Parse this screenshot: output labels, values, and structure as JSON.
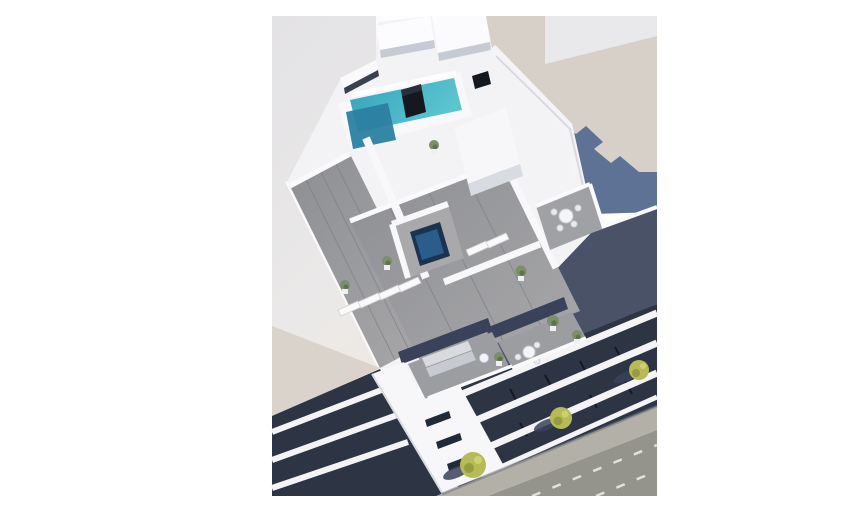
{
  "image": {
    "alt_text": "Aerial 3D architectural rendering of a modern white apartment building with a rooftop swimming pool, jacuzzi and sun-deck terraces, glass penthouse level, white balcony slabs over dark recessed floors, and a tree-lined street with dashed lane markings; portrait render centered on a white background"
  },
  "colors": {
    "page_white": "#ffffff",
    "sky_gray": "#e9e9eb",
    "ground_beige": "#d7d0c8",
    "shadow_blue": "#5e7296",
    "wall_gray": "#e6e5e8",
    "building_white": "#f3f3f5",
    "deck_gray": "#97989b",
    "pool_turquoise": "#41b6c8",
    "pool_deep": "#2b7fa0",
    "jacuzzi_navy": "#1c3350",
    "glass_blue": "#4a5268",
    "facade_dark": "#2d3545",
    "street_gray": "#94938c",
    "sidewalk_gray": "#b3b0a8",
    "lane_white": "#eceae2",
    "tree_green": "#b6bb58",
    "plant_green": "#7d8f6a"
  },
  "scene": {
    "elements": [
      "white background margins",
      "neighboring building wall (left)",
      "sunlit beige ground with stepped blue building shadow (top right)",
      "rooftop swimming pool with dark deep end",
      "black rooftop skylight boxes",
      "square navy jacuzzi on timber deck",
      "gray timber sun decks with white sun loungers",
      "potted green plants",
      "round white terrace dining tables with chairs",
      "penthouse terrace with corner sofa and coffee table",
      "dark glass penthouse walls",
      "white diagonal balcony slabs over dark recessed floors",
      "white stairwell columns with slit windows",
      "side facade stripes in shadow (bottom left)",
      "light sidewalk with street trees and shadows",
      "gray road with dashed white lane markings"
    ]
  }
}
